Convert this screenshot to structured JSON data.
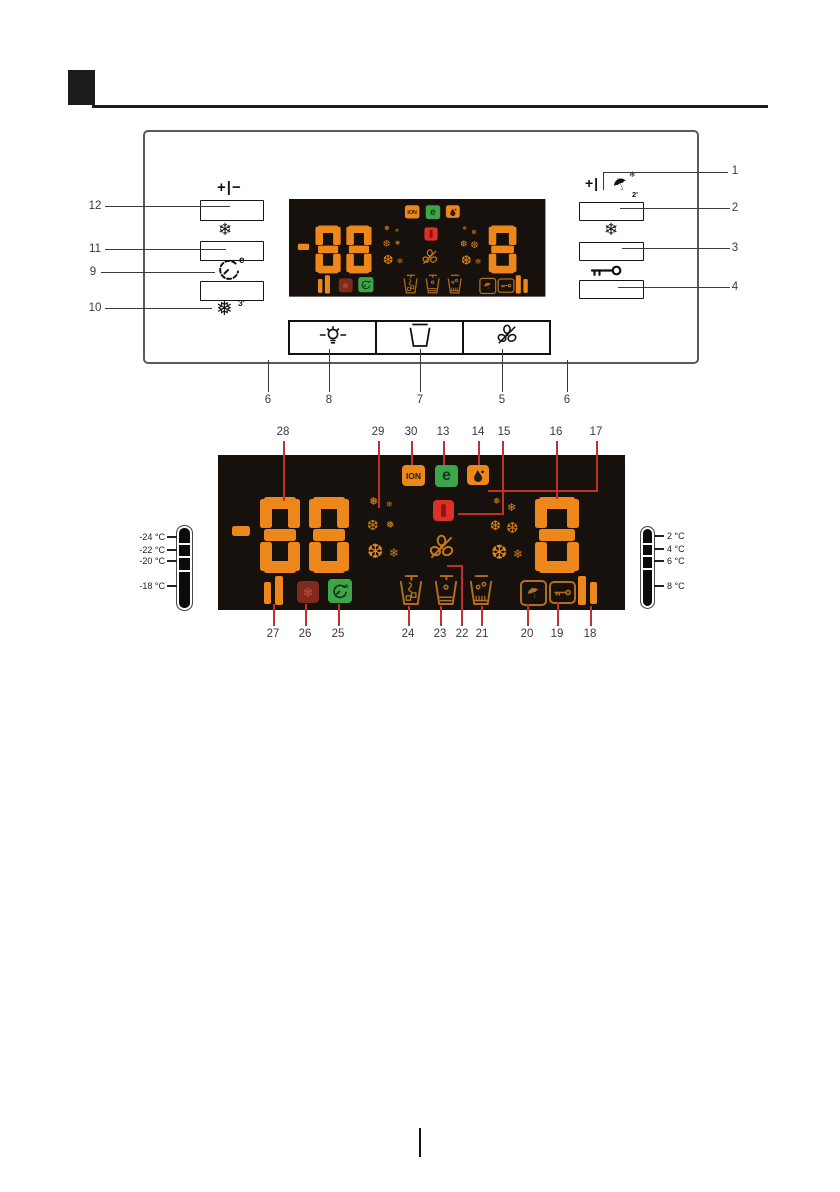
{
  "lcd": {
    "freezer_value": "-88",
    "fridge_value": "8",
    "ion_label": "ION",
    "eco_label": "e"
  },
  "figure1": {
    "plus_minus_label": "+|−",
    "plus_label": "+|",
    "holiday_minutes": "2'",
    "quick_freeze_minutes": "3'",
    "quick_cool_e": "e",
    "snowflake": "❄",
    "filled_snowflake": "❅",
    "umbrella": "☂",
    "callout_left": [
      "12",
      "11",
      "9",
      "10"
    ],
    "callout_right": [
      "1",
      "2",
      "3",
      "4"
    ],
    "callout_bottom": [
      "6",
      "8",
      "7",
      "5",
      "6"
    ]
  },
  "figure2": {
    "callout_top": [
      "28",
      "29",
      "30",
      "13",
      "14",
      "15",
      "16",
      "17"
    ],
    "callout_bottom": [
      "27",
      "26",
      "25",
      "24",
      "23",
      "22",
      "21",
      "20",
      "19",
      "18"
    ],
    "freezer_scale": [
      "-24 °C",
      "-22 °C",
      "-20 °C",
      "-18 °C"
    ],
    "fridge_scale": [
      "2 °C",
      "4 °C",
      "6 °C",
      "8 °C"
    ]
  },
  "colors": {
    "segment_orange": "#ED871C",
    "badge_green": "#3FA54A",
    "badge_red": "#DC3028",
    "badge_maroon": "#7E2A1E",
    "leader_red": "#C2302A"
  },
  "glyphs": {
    "snow_small": "❄",
    "snow_mid": "❅",
    "snow_big": "❆"
  }
}
